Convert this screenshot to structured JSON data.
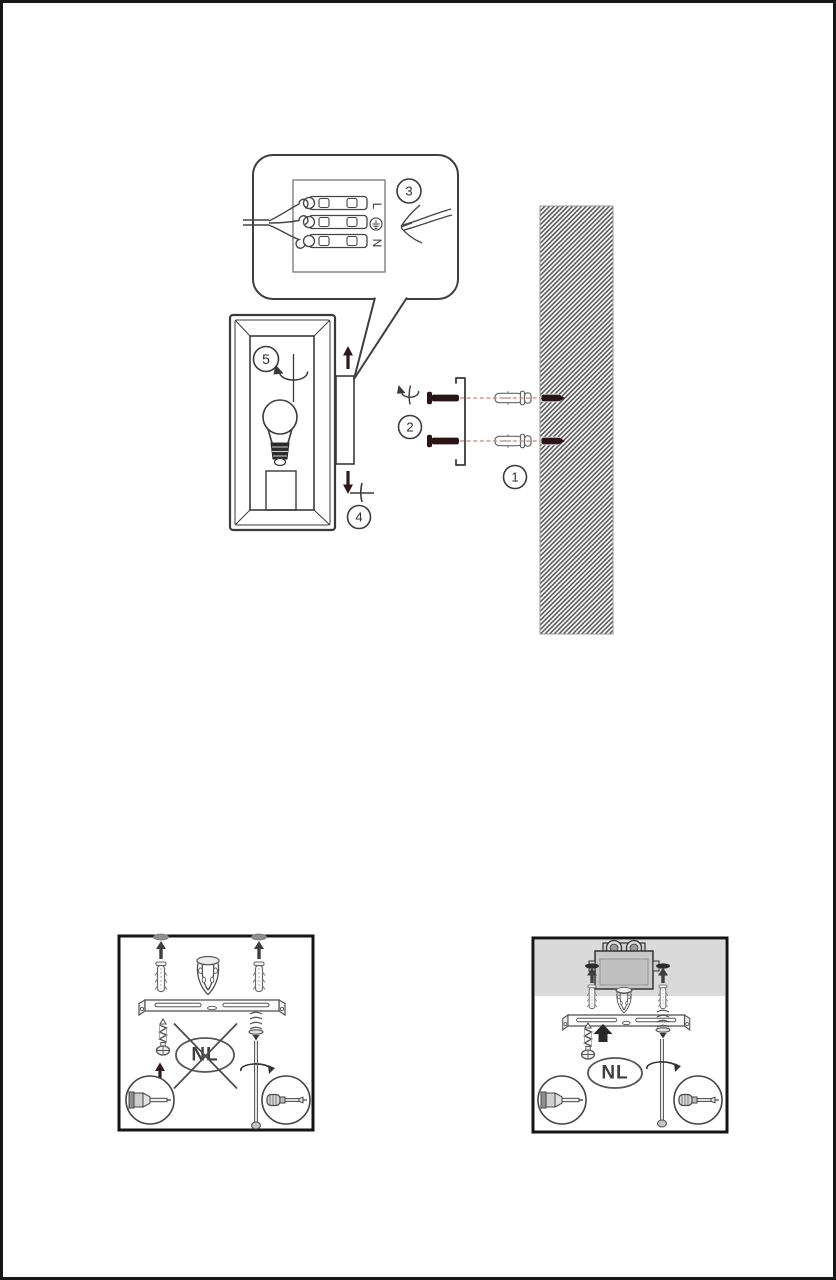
{
  "document_kind": "wall-lamp-mounting-instruction-diagram",
  "colors": {
    "line": "#3a3a3a",
    "panel_line": "#555555",
    "screw_dark_red": "#2a1416",
    "arrow_dark_red": "#33181a",
    "dashed_guide_pink": "#cc8484",
    "wall_hatch": "#4f4f4f",
    "ceiling_gray": "#dadada",
    "cap_gray": "#8f8f8f",
    "page_border": "#161616"
  },
  "main_diagram": {
    "steps": {
      "step1": "1",
      "step2": "2",
      "step3": "3",
      "step4": "4",
      "step5": "5"
    },
    "terminal_block": {
      "live": "L",
      "neutral": "N"
    }
  },
  "panels": {
    "left": {
      "country_label": "NL",
      "crossed_out": true
    },
    "right": {
      "country_label": "NL",
      "crossed_out": false
    }
  },
  "icons": {
    "rotate_screw_icon": "curved-arrow",
    "phillips_screwdriver_icon": "plus-cross",
    "insert_up_arrow_icon": "up-arrow",
    "insert_down_arrow_icon": "down-arrow",
    "earth_ground_icon": "circle-with-ground-bars"
  }
}
